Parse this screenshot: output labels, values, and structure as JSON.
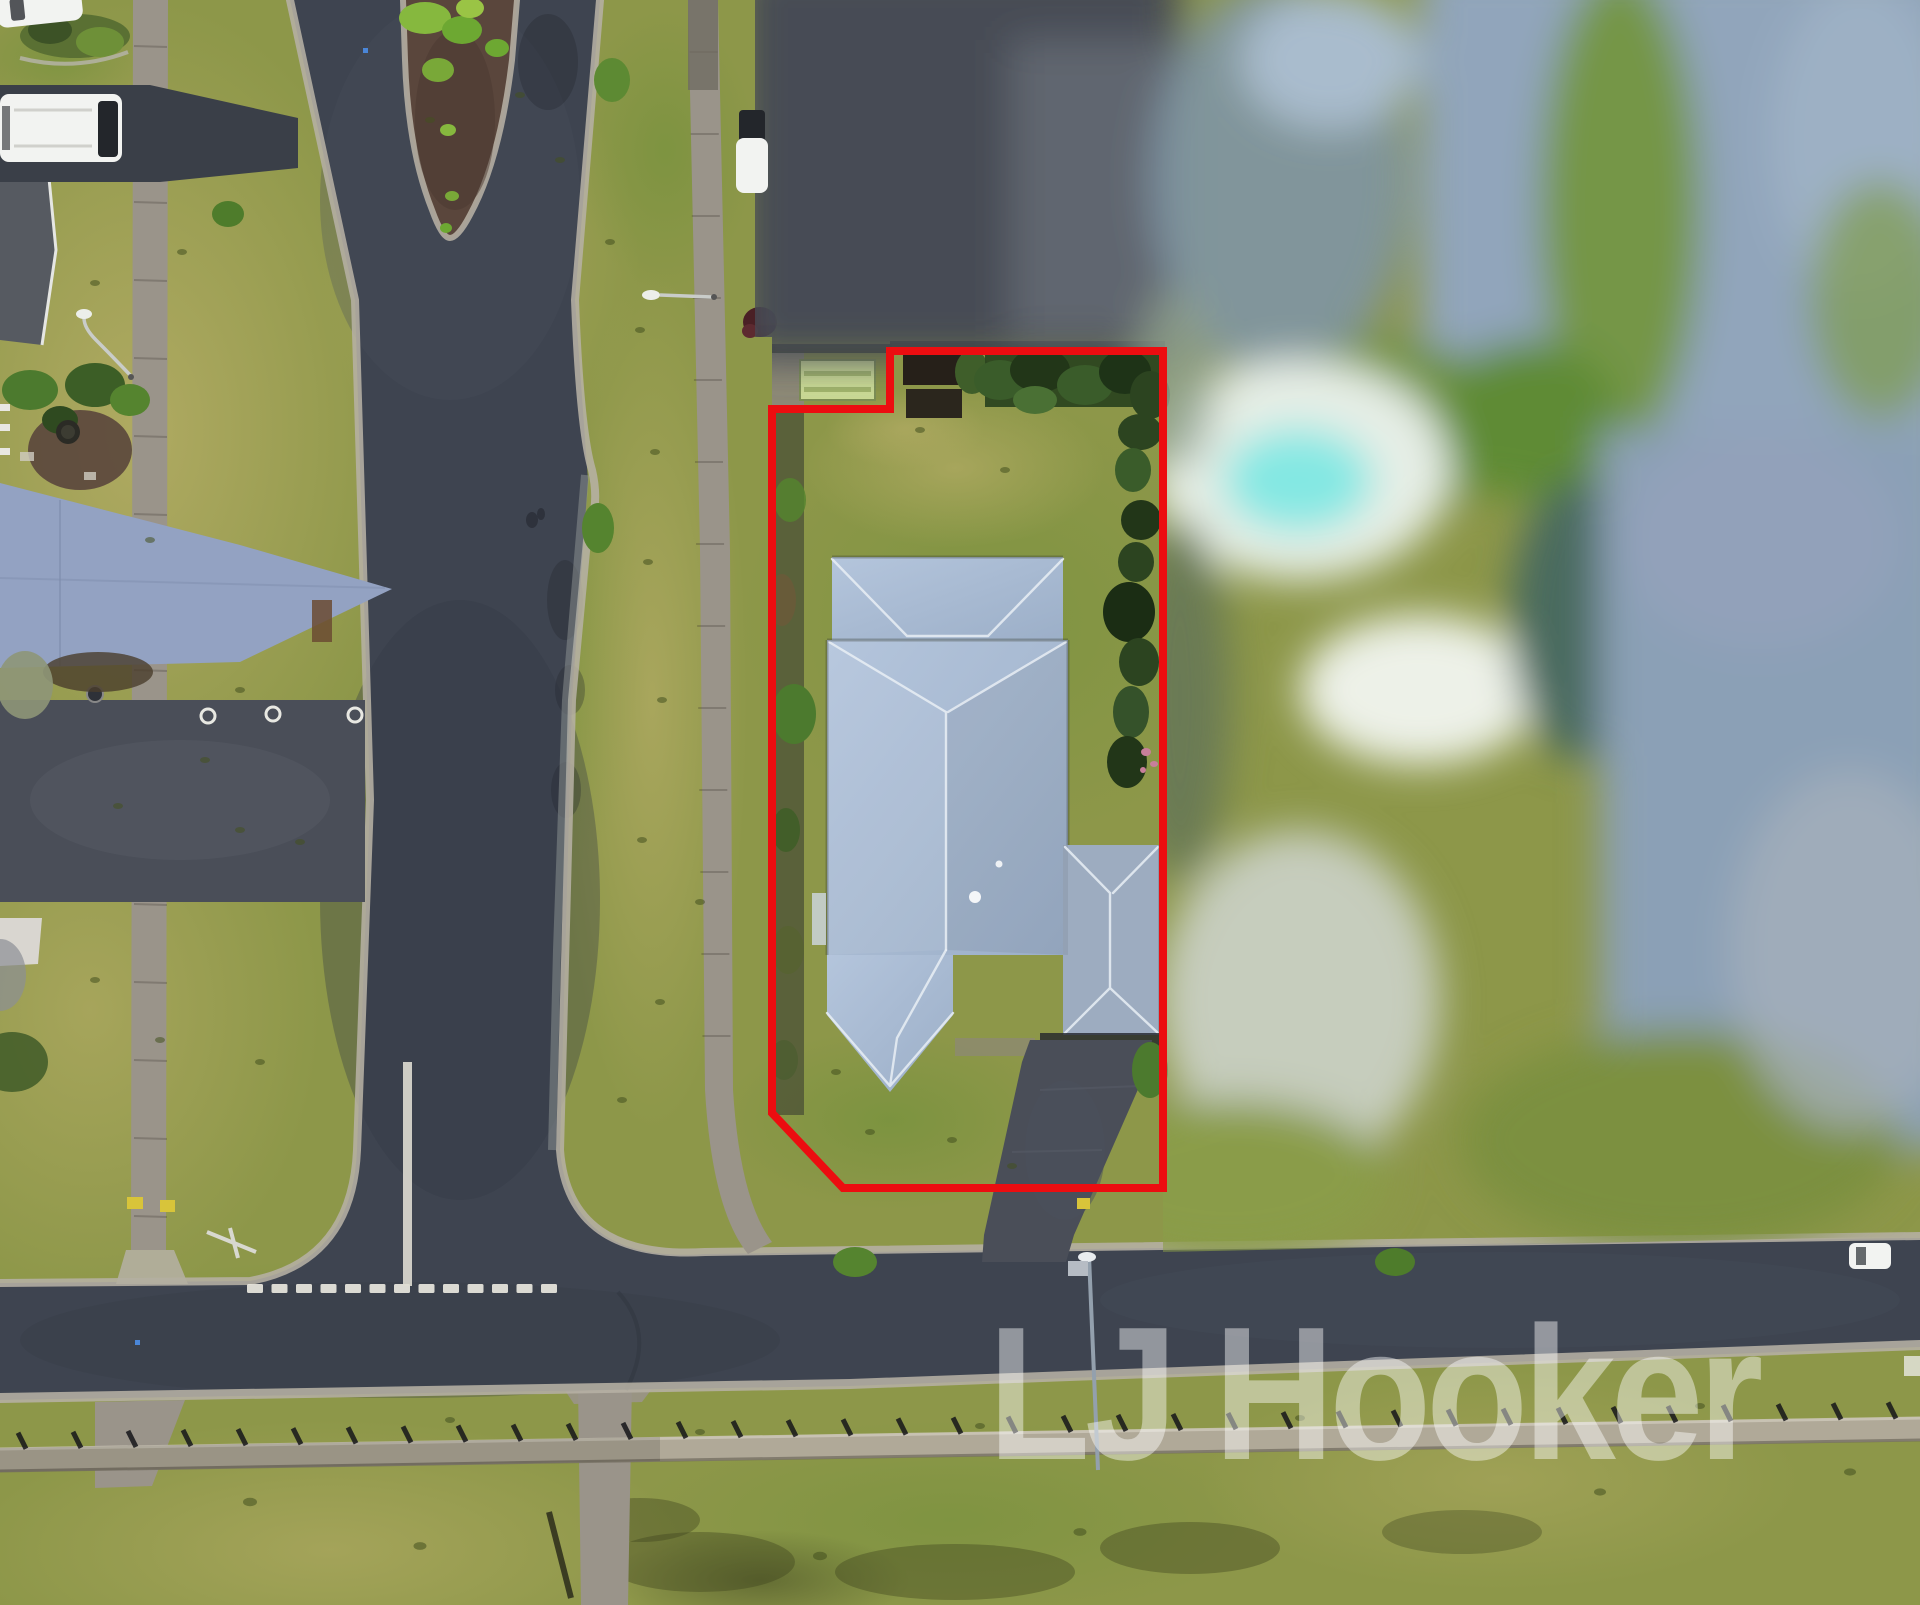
{
  "title": "Aerial drone photograph of a residential property outlined in red",
  "watermark": {
    "text": "LJ Hooker",
    "color": "#ffffff",
    "opacity": 0.44
  },
  "boundary": {
    "label": "red property boundary outline",
    "color": "#ec0d10"
  },
  "colors": {
    "grass": "#8d9749",
    "grassDry": "#bbb06a",
    "grassGreen": "#6e9038",
    "asphalt": "#3e4450",
    "kerb": "#b6b1a4",
    "path": "#9a948a",
    "roof": "#abbed6",
    "roofDark": "#9dacc0",
    "ridge": "#e9eef5",
    "drive": "#4a4e58",
    "driveBlue": "#93a2c2",
    "shed": "#ccdc96",
    "shedStripe": "#a2b66c",
    "mulch": "#5a463c",
    "hedge": "#2c4420",
    "red": "#ec0d10",
    "pool": "#84e8e3",
    "blurRoofDark": "#474c55",
    "blurRoofBlue": "#91a5bb",
    "white": "#f2f3f1",
    "wall": "#b0a998",
    "wmcolor": "#ffffff"
  },
  "scene": {
    "objects": [
      "subject property outlined in red",
      "hip-roofed house with blue-grey metal roof",
      "attached garage wing and rear roof wing",
      "light green garden shed",
      "backyard lawn with hedges and garden beds",
      "driveway leading to street",
      "T-intersection with dashed give-way line and centre line",
      "landscaped median island with shrubs",
      "concrete footpaths and kerbs",
      "white van parked on a driveway",
      "white car at top of frame",
      "white car on road at right",
      "street lamps",
      "privacy-blurred neighbouring properties",
      "blurred swimming pool",
      "low retaining wall with posts",
      "open grass field in foreground"
    ]
  }
}
